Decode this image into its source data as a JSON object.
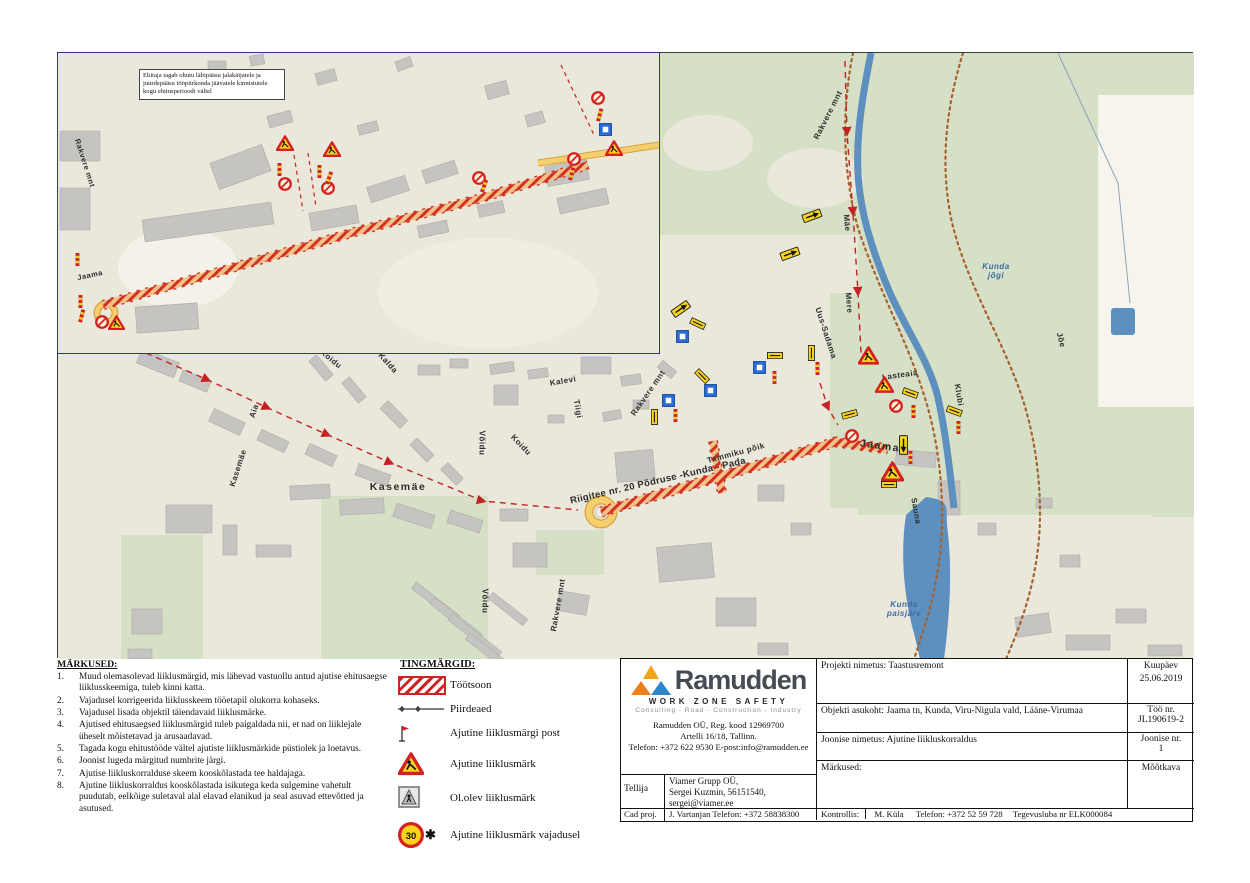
{
  "notes": {
    "title": "MÄRKUSED:",
    "items": [
      "Muud olemasolevad liiklusmärgid, mis lähevad vastuollu antud ajutise ehitusaegse liiklusskeemiga, tuleb kinni katta.",
      "Vajadusel korrigeerida liiklusskeem tööetapil olukorra kohaseks.",
      "Vajadusel lisada objektil täiendavaid liiklusmärke.",
      "Ajutised ehitusaegsed liiklusmärgid tuleb paigaldada nii, et nad on liiklejale üheselt mõistetavad ja arusaadavad.",
      "Tagada kogu ehitustööde vältel ajutiste liiklusmärkide püstiolek ja loetavus.",
      "Joonist lugeda märgitud numbrite järgi.",
      "Ajutise liikluskorralduse skeem kooskõlastada tee haldajaga.",
      "Ajutine liikluskorraldus kooskõlastada isikutega keda sulgemine vahetult puudutab, eelkõige suletaval alal elavad elanikud ja seal asuvad ettevõtted ja asutused."
    ]
  },
  "legend": {
    "title": "TINGMÄRGID:",
    "items": [
      {
        "icon": "work",
        "label": "Töötsoon"
      },
      {
        "icon": "fence",
        "label": "Piirdeaed"
      },
      {
        "icon": "post",
        "label": "Ajutine liiklusmärgi post"
      },
      {
        "icon": "warn",
        "label": "Ajutine liiklusmärk"
      },
      {
        "icon": "oldsign",
        "label": "Ol.olev liiklusmärk"
      },
      {
        "icon": "s30",
        "label": "Ajutine liiklusmärk vajadusel"
      }
    ]
  },
  "title_block": {
    "brand": "Ramudden",
    "tagline": "WORK ZONE SAFETY",
    "subtagline": "Consulting - Road - Construction - Industry",
    "reg": "Ramudden OÜ, Reg. kood 12969700",
    "address": "Artelli 16/18, Tallinn.",
    "phone": "Telefon: +372 622 9530  E-post:info@ramudden.ee",
    "tellija_label": "Tellija",
    "tellija_line1": "Viamer Grupp OÜ,",
    "tellija_line2": "Sergei Kuzmin, 56151540,",
    "tellija_line3": "sergei@viamer.ee",
    "cadproj_label": "Cad proj.",
    "cadproj_value": "J. Vartanjan Telefon: +372 58838300",
    "kontrollis_label": "Kontrollis:",
    "kontrollis_name": "M. Küla",
    "kontrollis_phone": "Telefon: +372 52 59 728",
    "kontrollis_license": "Tegevusluba nr ELK000084",
    "rows": [
      {
        "label": "Projekti nimetus:",
        "value": "Taastusremont"
      },
      {
        "label": "Objekti asukoht:",
        "value": "Jaama tn, Kunda, Viru-Nigula vald, Lääne-Virumaa"
      },
      {
        "label": "Joonise nimetus:",
        "value": "Ajutine liikluskorraldus"
      },
      {
        "label": "Märkused:",
        "value": ""
      }
    ],
    "side": [
      {
        "label": "Kuupäev",
        "value": "25.06.2019"
      },
      {
        "label": "Töö nr.",
        "value": "JL190619-2"
      },
      {
        "label": "Joonise nr.",
        "value": "1"
      },
      {
        "label": "Mõõtkava",
        "value": ""
      }
    ]
  },
  "map": {
    "note_box": "Ehitaja tagab ohutu läbipääsu jalakäijatele ja juurdepääsu tööpiirkonda jäävatele kinnistutele kogu ehitusperioodi vältel",
    "labels_main": [
      {
        "text": "Rakvere mnt",
        "x": 770,
        "y": 62,
        "r": -63,
        "cls": ""
      },
      {
        "text": "Mäe",
        "x": 789,
        "y": 170,
        "r": 85,
        "cls": ""
      },
      {
        "text": "Mere",
        "x": 791,
        "y": 250,
        "r": 85,
        "cls": ""
      },
      {
        "text": "Uus-Sadama",
        "x": 768,
        "y": 280,
        "r": 72,
        "cls": ""
      },
      {
        "text": "Jaama",
        "x": 822,
        "y": 393,
        "r": 8,
        "cls": "big"
      },
      {
        "text": "Lasteaia",
        "x": 842,
        "y": 322,
        "r": -8,
        "cls": ""
      },
      {
        "text": "Klubi",
        "x": 901,
        "y": 342,
        "r": 80,
        "cls": ""
      },
      {
        "text": "Sauna",
        "x": 858,
        "y": 458,
        "r": 80,
        "cls": ""
      },
      {
        "text": "Jõe",
        "x": 1003,
        "y": 287,
        "r": 75,
        "cls": ""
      },
      {
        "text": "Kunda\njõgi",
        "x": 938,
        "y": 218,
        "r": 0,
        "cls": "water"
      },
      {
        "text": "Kunda\npaisjärv",
        "x": 846,
        "y": 556,
        "r": 0,
        "cls": "water"
      },
      {
        "text": "Riigitee nr. 20 Põdruse -Kunda - Pada",
        "x": 600,
        "y": 428,
        "r": -13,
        "cls": "road20"
      },
      {
        "text": "Kasemäe",
        "x": 340,
        "y": 434,
        "r": 0,
        "cls": "big"
      },
      {
        "text": "Kasemäe",
        "x": 180,
        "y": 415,
        "r": -72,
        "cls": ""
      },
      {
        "text": "Aia",
        "x": 196,
        "y": 358,
        "r": -72,
        "cls": ""
      },
      {
        "text": "Võidu",
        "x": 424,
        "y": 390,
        "r": 90,
        "cls": ""
      },
      {
        "text": "Võidu",
        "x": 427,
        "y": 548,
        "r": 90,
        "cls": ""
      },
      {
        "text": "Koidu",
        "x": 463,
        "y": 392,
        "r": 46,
        "cls": ""
      },
      {
        "text": "Koidu",
        "x": 273,
        "y": 306,
        "r": 40,
        "cls": ""
      },
      {
        "text": "Kalda",
        "x": 330,
        "y": 310,
        "r": 48,
        "cls": ""
      },
      {
        "text": "Kalevi",
        "x": 505,
        "y": 328,
        "r": -10,
        "cls": ""
      },
      {
        "text": "Tiigi",
        "x": 520,
        "y": 356,
        "r": 80,
        "cls": ""
      },
      {
        "text": "Rakvere mnt",
        "x": 590,
        "y": 340,
        "r": -55,
        "cls": ""
      },
      {
        "text": "Rakvere mnt",
        "x": 500,
        "y": 552,
        "r": -80,
        "cls": ""
      },
      {
        "text": "Tammiku põik",
        "x": 678,
        "y": 400,
        "r": -15,
        "cls": ""
      }
    ],
    "labels_inset": [
      {
        "text": "Rakvere mnt",
        "x": 27,
        "y": 110,
        "r": 72,
        "cls": "inset"
      },
      {
        "text": "Jaama",
        "x": 32,
        "y": 222,
        "r": -12,
        "cls": "inset"
      }
    ],
    "signs_main": [
      {
        "t": "arrow",
        "x": 743,
        "y": 162,
        "r": -20
      },
      {
        "t": "arrow",
        "x": 721,
        "y": 200,
        "r": -20
      },
      {
        "t": "arrow",
        "x": 612,
        "y": 258,
        "r": -35
      },
      {
        "t": "blue",
        "x": 618,
        "y": 277,
        "r": 0
      },
      {
        "t": "plate",
        "x": 634,
        "y": 264,
        "r": 25
      },
      {
        "t": "plate",
        "x": 641,
        "y": 315,
        "r": 45
      },
      {
        "t": "blue",
        "x": 646,
        "y": 331,
        "r": 0
      },
      {
        "t": "blue",
        "x": 604,
        "y": 341,
        "r": 0
      },
      {
        "t": "plate",
        "x": 600,
        "y": 356,
        "r": 90
      },
      {
        "t": "post",
        "x": 615,
        "y": 356,
        "r": 0
      },
      {
        "t": "blue",
        "x": 695,
        "y": 308,
        "r": 0
      },
      {
        "t": "plate",
        "x": 709,
        "y": 299,
        "r": 0
      },
      {
        "t": "post",
        "x": 714,
        "y": 318,
        "r": 0
      },
      {
        "t": "plate",
        "x": 757,
        "y": 292,
        "r": 90
      },
      {
        "t": "post",
        "x": 757,
        "y": 309,
        "r": 0
      },
      {
        "t": "warn",
        "x": 800,
        "y": 293,
        "r": 0,
        "s": 21
      },
      {
        "t": "warn",
        "x": 817,
        "y": 323,
        "r": 0,
        "s": 19
      },
      {
        "t": "noentry",
        "x": 831,
        "y": 346,
        "r": 0
      },
      {
        "t": "plate",
        "x": 846,
        "y": 334,
        "r": 20
      },
      {
        "t": "post",
        "x": 853,
        "y": 352,
        "r": 0
      },
      {
        "t": "plate",
        "x": 783,
        "y": 360,
        "r": -15
      },
      {
        "t": "noentry",
        "x": 787,
        "y": 376,
        "r": 0
      },
      {
        "t": "plate",
        "x": 890,
        "y": 352,
        "r": 20
      },
      {
        "t": "post",
        "x": 898,
        "y": 368,
        "r": 0
      },
      {
        "t": "arrow",
        "x": 850,
        "y": 382,
        "r": 90
      },
      {
        "t": "post",
        "x": 850,
        "y": 398,
        "r": 0
      },
      {
        "t": "warn",
        "x": 823,
        "y": 408,
        "r": 0,
        "s": 23
      },
      {
        "t": "plate",
        "x": 823,
        "y": 428,
        "r": 0
      }
    ],
    "signs_inset": [
      {
        "t": "warn",
        "x": 218,
        "y": 82,
        "r": 0,
        "s": 18
      },
      {
        "t": "warn",
        "x": 265,
        "y": 88,
        "r": 0,
        "s": 18
      },
      {
        "t": "post",
        "x": 219,
        "y": 110,
        "r": 0
      },
      {
        "t": "noentry",
        "x": 220,
        "y": 124,
        "r": 0
      },
      {
        "t": "post",
        "x": 259,
        "y": 112,
        "r": 0
      },
      {
        "t": "noentry",
        "x": 263,
        "y": 128,
        "r": 0
      },
      {
        "t": "post",
        "x": 271,
        "y": 118,
        "r": 20
      },
      {
        "t": "noentry",
        "x": 414,
        "y": 118,
        "r": 0
      },
      {
        "t": "post",
        "x": 426,
        "y": 126,
        "r": 20
      },
      {
        "t": "noentry",
        "x": 509,
        "y": 99,
        "r": 0
      },
      {
        "t": "post",
        "x": 513,
        "y": 114,
        "r": 15
      },
      {
        "t": "noentry",
        "x": 533,
        "y": 38,
        "r": 0
      },
      {
        "t": "post",
        "x": 541,
        "y": 55,
        "r": 15
      },
      {
        "t": "blue",
        "x": 541,
        "y": 70,
        "r": 0
      },
      {
        "t": "warn",
        "x": 547,
        "y": 87,
        "r": 0,
        "s": 18
      },
      {
        "t": "post",
        "x": 17,
        "y": 200,
        "r": 0
      },
      {
        "t": "post",
        "x": 20,
        "y": 242,
        "r": 0
      },
      {
        "t": "post",
        "x": 23,
        "y": 256,
        "r": 15
      },
      {
        "t": "noentry",
        "x": 37,
        "y": 262,
        "r": 0
      },
      {
        "t": "warn",
        "x": 50,
        "y": 262,
        "r": 0,
        "s": 17
      }
    ],
    "buildings_main": [
      [
        80,
        302,
        40,
        16,
        22
      ],
      [
        122,
        322,
        30,
        12,
        22
      ],
      [
        250,
        310,
        26,
        10,
        50
      ],
      [
        283,
        332,
        26,
        10,
        50
      ],
      [
        322,
        356,
        28,
        11,
        45
      ],
      [
        360,
        312,
        22,
        10,
        0
      ],
      [
        392,
        306,
        18,
        9,
        0
      ],
      [
        432,
        310,
        24,
        10,
        -8
      ],
      [
        470,
        316,
        20,
        9,
        -8
      ],
      [
        523,
        304,
        30,
        17,
        0
      ],
      [
        436,
        332,
        24,
        20,
        0
      ],
      [
        563,
        322,
        20,
        10,
        -8
      ],
      [
        600,
        312,
        18,
        9,
        40
      ],
      [
        575,
        347,
        16,
        9,
        0
      ],
      [
        545,
        358,
        18,
        9,
        -10
      ],
      [
        490,
        362,
        16,
        8,
        0
      ],
      [
        152,
        362,
        34,
        14,
        25
      ],
      [
        200,
        382,
        30,
        12,
        25
      ],
      [
        248,
        396,
        30,
        12,
        25
      ],
      [
        298,
        416,
        34,
        12,
        20
      ],
      [
        352,
        392,
        24,
        10,
        45
      ],
      [
        383,
        416,
        22,
        10,
        45
      ],
      [
        232,
        432,
        40,
        14,
        -3
      ],
      [
        282,
        446,
        44,
        15,
        -3
      ],
      [
        336,
        456,
        40,
        14,
        18
      ],
      [
        390,
        462,
        34,
        13,
        18
      ],
      [
        442,
        456,
        28,
        12,
        0
      ],
      [
        108,
        452,
        46,
        28,
        0
      ],
      [
        165,
        472,
        14,
        30,
        0
      ],
      [
        198,
        492,
        35,
        12,
        0
      ],
      [
        350,
        545,
        55,
        8,
        38
      ],
      [
        368,
        562,
        60,
        8,
        38
      ],
      [
        386,
        579,
        62,
        8,
        38
      ],
      [
        404,
        596,
        55,
        8,
        38
      ],
      [
        428,
        552,
        44,
        8,
        38
      ],
      [
        74,
        556,
        30,
        25,
        0
      ],
      [
        70,
        596,
        24,
        10,
        0
      ],
      [
        558,
        398,
        38,
        30,
        -5
      ],
      [
        600,
        492,
        55,
        35,
        -5
      ],
      [
        658,
        545,
        40,
        28,
        0
      ],
      [
        700,
        590,
        30,
        12,
        0
      ],
      [
        455,
        490,
        34,
        24,
        0
      ],
      [
        500,
        540,
        30,
        20,
        10
      ],
      [
        700,
        432,
        26,
        16,
        0
      ],
      [
        733,
        470,
        20,
        12,
        0
      ],
      [
        838,
        398,
        40,
        15,
        5
      ],
      [
        880,
        428,
        22,
        34,
        0
      ],
      [
        920,
        470,
        18,
        12,
        0
      ],
      [
        958,
        562,
        34,
        20,
        -8
      ],
      [
        1008,
        582,
        44,
        15,
        0
      ],
      [
        1058,
        556,
        30,
        14,
        0
      ],
      [
        1090,
        592,
        34,
        11,
        0
      ],
      [
        1002,
        502,
        20,
        12,
        0
      ],
      [
        978,
        445,
        16,
        10,
        0
      ]
    ],
    "buildings_inset": [
      [
        85,
        158,
        130,
        22,
        -8
      ],
      [
        252,
        156,
        48,
        18,
        -10
      ],
      [
        155,
        100,
        55,
        28,
        -20
      ],
      [
        310,
        128,
        40,
        16,
        -18
      ],
      [
        365,
        112,
        34,
        14,
        -18
      ],
      [
        150,
        8,
        18,
        12,
        0
      ],
      [
        192,
        2,
        14,
        10,
        -10
      ],
      [
        258,
        18,
        20,
        12,
        -15
      ],
      [
        338,
        6,
        16,
        10,
        -20
      ],
      [
        428,
        30,
        22,
        14,
        -15
      ],
      [
        468,
        60,
        18,
        12,
        -15
      ],
      [
        488,
        110,
        42,
        20,
        -10
      ],
      [
        500,
        140,
        50,
        16,
        -12
      ],
      [
        2,
        78,
        40,
        30,
        0
      ],
      [
        2,
        135,
        30,
        42,
        0
      ],
      [
        78,
        252,
        62,
        26,
        -4
      ],
      [
        360,
        170,
        30,
        12,
        -12
      ],
      [
        420,
        150,
        26,
        12,
        -12
      ],
      [
        210,
        60,
        24,
        12,
        -15
      ],
      [
        300,
        70,
        20,
        10,
        -15
      ]
    ]
  }
}
